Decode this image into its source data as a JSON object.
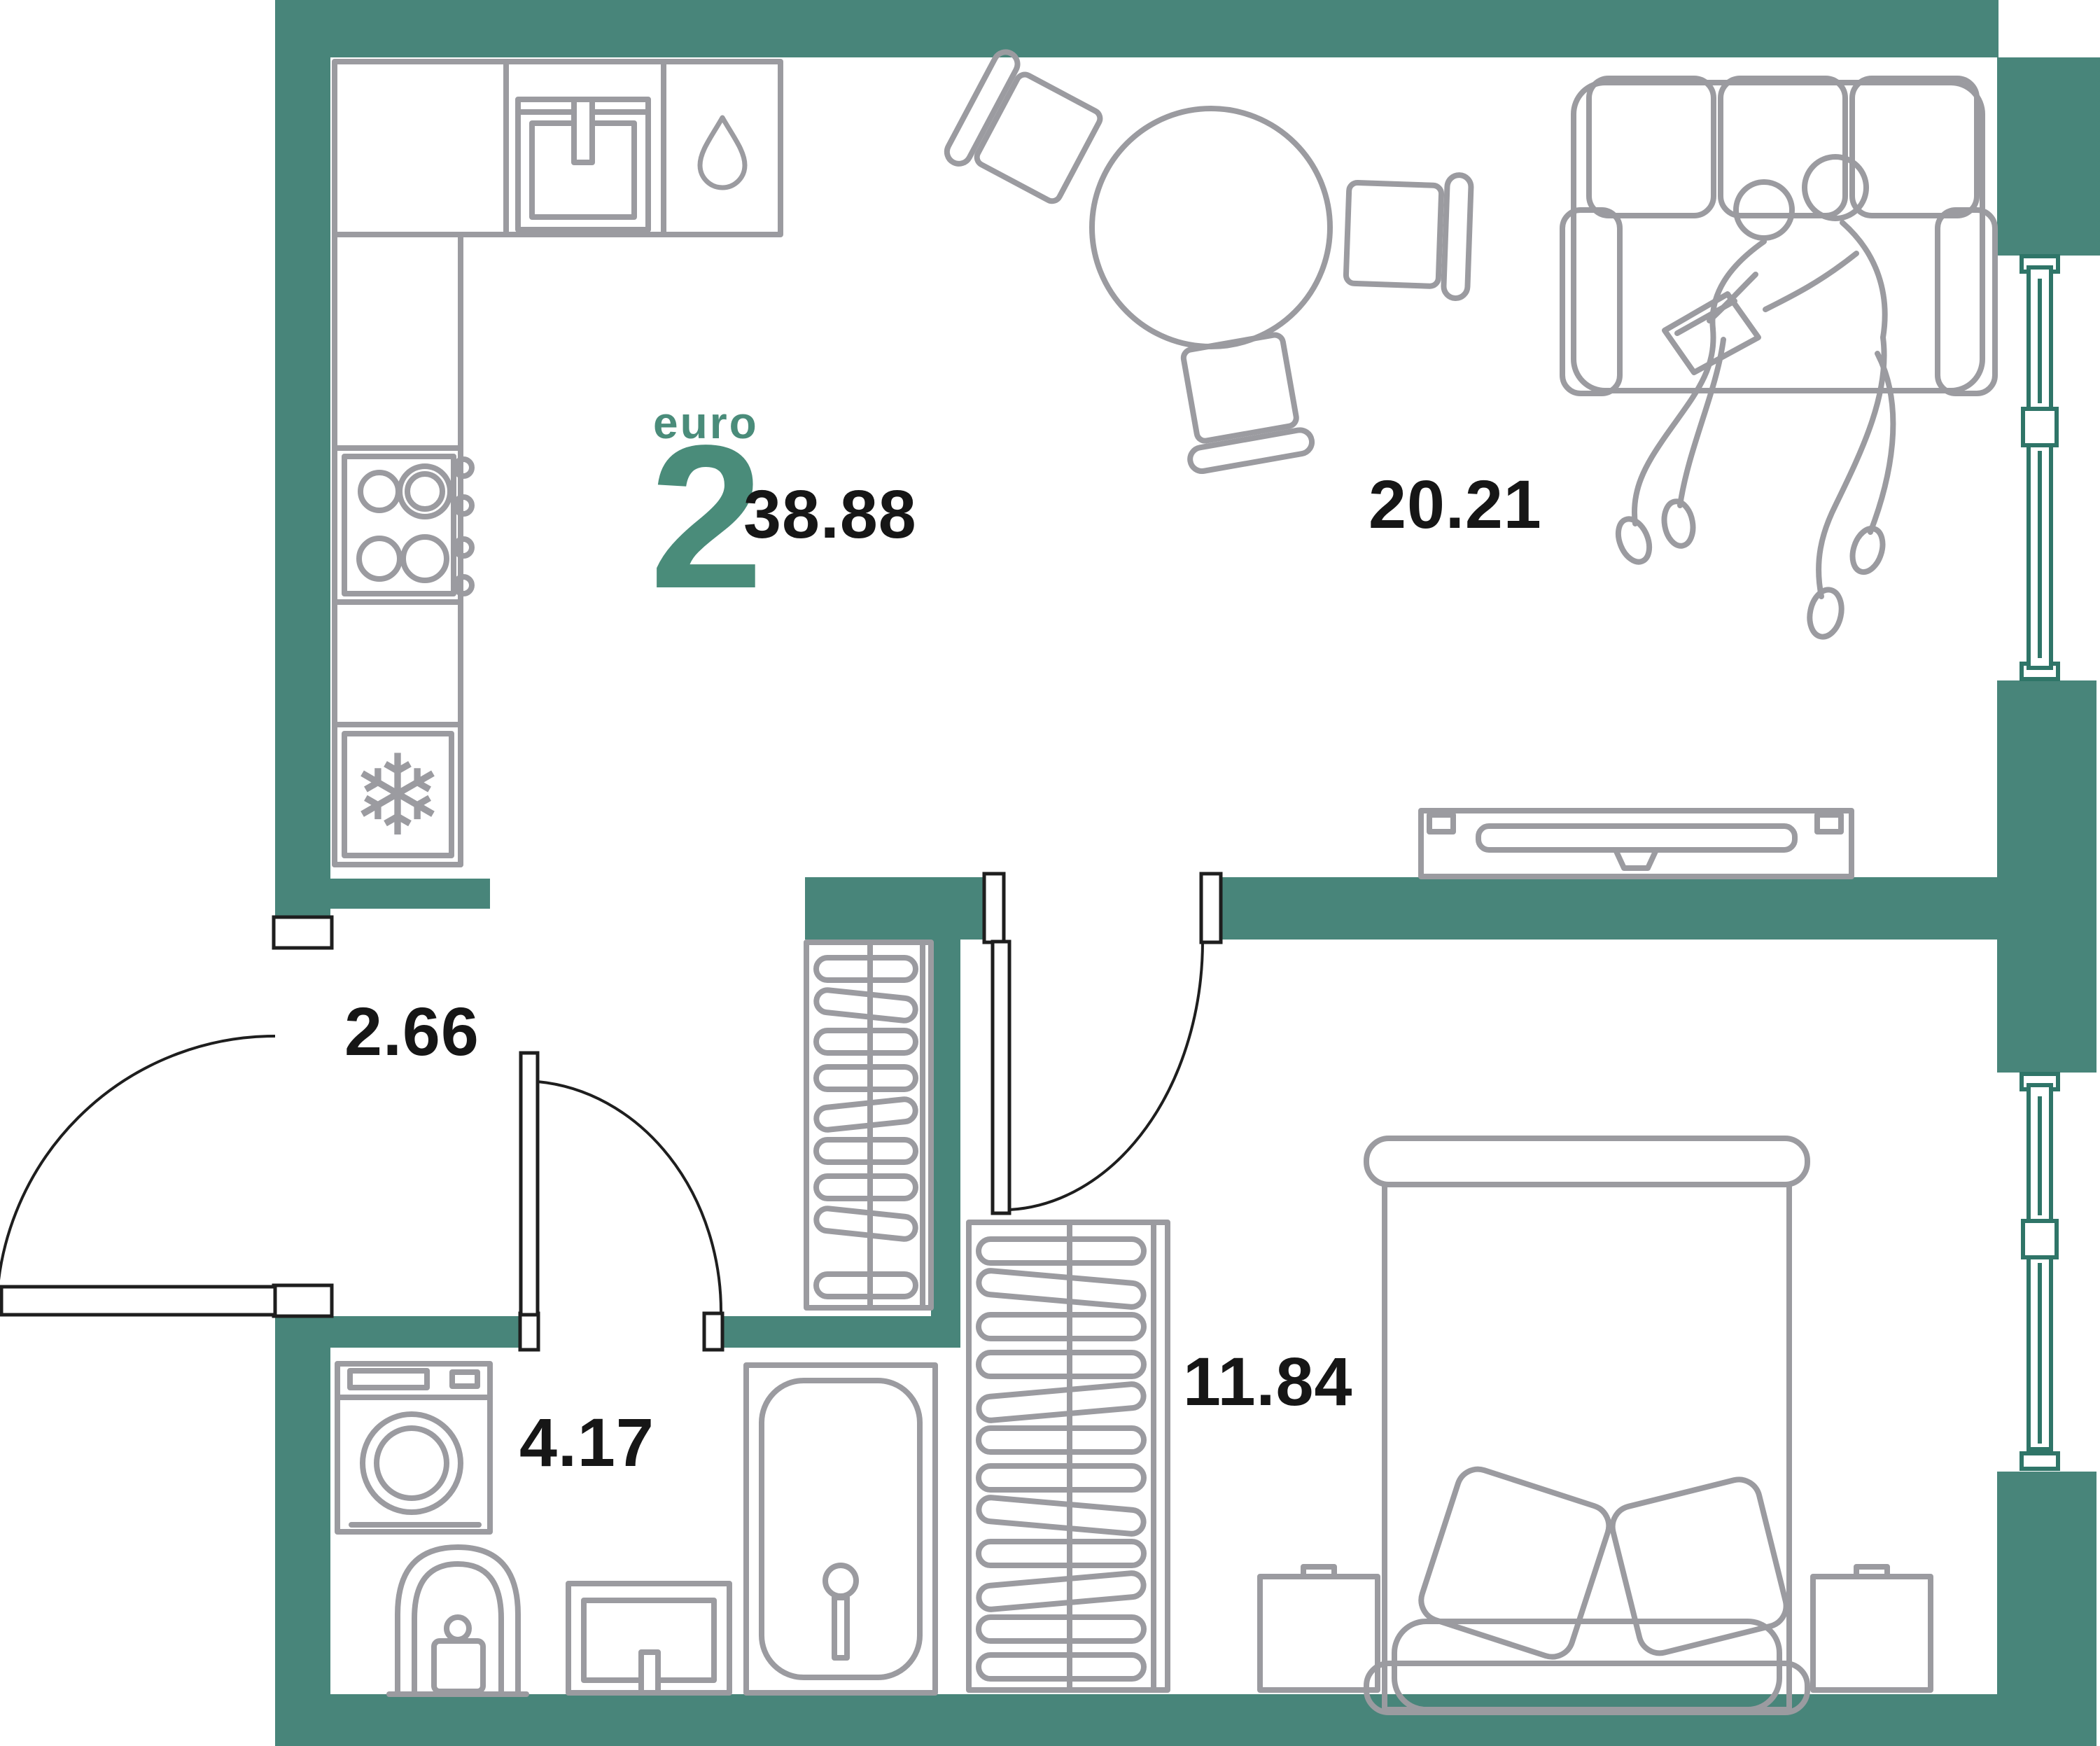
{
  "plan": {
    "title": "euro 2 apartment floor plan",
    "unit": {
      "type_label": "euro",
      "rooms_count": "2",
      "total_area": "38.88"
    },
    "rooms": [
      {
        "id": "living-kitchen",
        "area_label": "20.21"
      },
      {
        "id": "hallway",
        "area_label": "2.66"
      },
      {
        "id": "bathroom",
        "area_label": "4.17"
      },
      {
        "id": "bedroom",
        "area_label": "11.84"
      }
    ],
    "icons": {
      "snowflake_glyph": "❄",
      "names": [
        "snowflake-icon",
        "water-drop-icon"
      ]
    },
    "colors": {
      "wall": "#48857a",
      "window_frame": "#2f7568",
      "furniture_line": "#9b9ba0",
      "accent_text": "#4a8c7a",
      "number_text": "#161616",
      "background": "#ffffff"
    },
    "furniture": [
      "kitchen-counter",
      "kitchen-sink",
      "stove",
      "fridge",
      "dining-table",
      "chair",
      "sofa",
      "tv-console",
      "hall-wardrobe",
      "bedroom-wardrobe",
      "washing-machine",
      "toilet",
      "washbasin",
      "bathtub",
      "bed",
      "nightstand"
    ]
  }
}
